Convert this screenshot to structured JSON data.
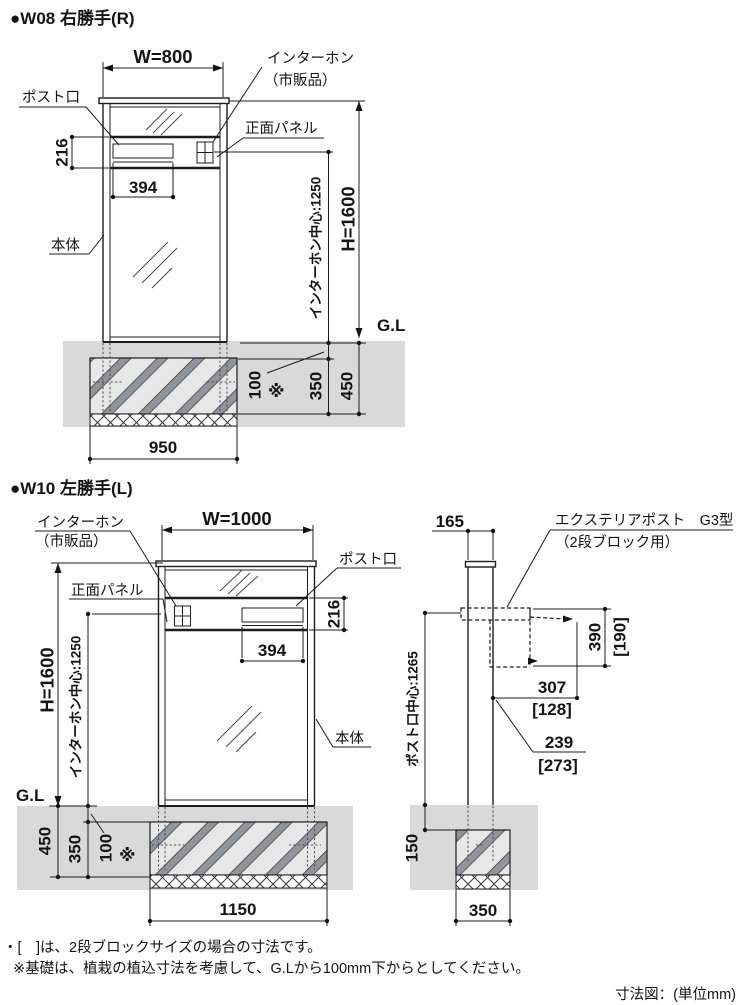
{
  "page": {
    "note1": "・[　]は、2段ブロックサイズの場合の寸法です。",
    "note2": "※基礎は、植栽の植込寸法を考慮して、G.Lから100mm下からとしてください。",
    "unit_caption": "寸法図：(単位mm)"
  },
  "colors": {
    "ground": "#d8d9d8",
    "foundation_fill": "#e6e7e6",
    "stripe": "#8f959a",
    "line": "#1c1c1c"
  },
  "w08": {
    "title": "●W08 右勝手(R)",
    "width_dim": "W=800",
    "intercom_label_1": "インターホン",
    "intercom_label_2": "（市販品）",
    "post_slot_label": "ポスト口",
    "front_panel_label": "正面パネル",
    "body_label": "本体",
    "gl_label": "G.L",
    "panel_height": "216",
    "slot_width": "394",
    "intercom_center": "インターホン中心:1250",
    "height_dim": "H=1600",
    "embed_top": "100",
    "embed_note": "※",
    "foundation_height": "350",
    "embed_total": "450",
    "foundation_width": "950"
  },
  "w10": {
    "title": "●W10 左勝手(L)",
    "width_dim": "W=1000",
    "intercom_label_1": "インターホン",
    "intercom_label_2": "（市販品）",
    "post_slot_label": "ポスト口",
    "front_panel_label": "正面パネル",
    "body_label": "本体",
    "gl_label": "G.L",
    "panel_height": "216",
    "slot_width": "394",
    "intercom_center": "インターホン中心:1250",
    "height_dim": "H=1600",
    "embed_top": "100",
    "embed_note": "※",
    "foundation_height": "350",
    "embed_total": "450",
    "foundation_width": "1150"
  },
  "side": {
    "pillar_depth": "165",
    "product_label_1": "エクステリアポスト　G3型",
    "product_label_2": "（2段ブロック用）",
    "post_center": "ポスト口中心:1265",
    "box_height": "390",
    "box_height_alt": "[190]",
    "depth_1": "307",
    "depth_1_alt": "[128]",
    "depth_2": "239",
    "depth_2_alt": "[273]",
    "embed_top": "150",
    "foundation_width": "350"
  }
}
